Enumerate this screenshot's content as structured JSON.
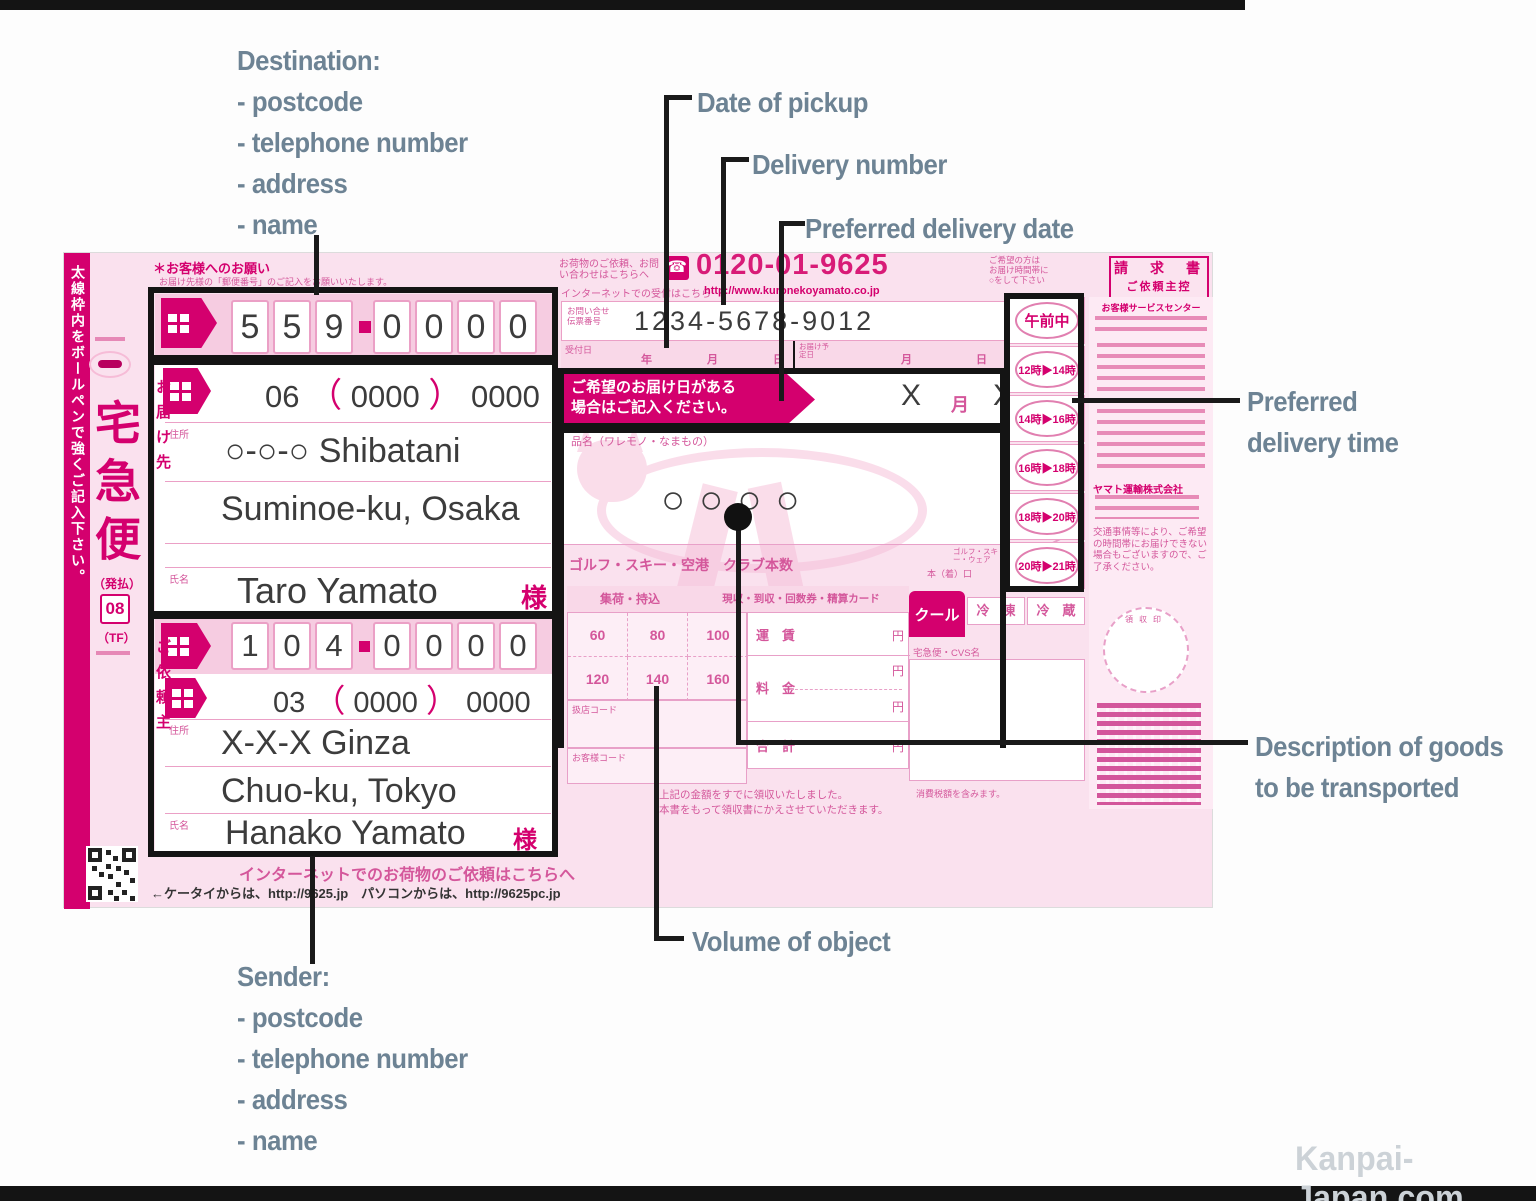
{
  "annotations": {
    "destination_title": "Destination:",
    "destination_items": [
      "- postcode",
      "- telephone number",
      "- address",
      "- name"
    ],
    "sender_title": "Sender:",
    "sender_items": [
      "- postcode",
      "- telephone number",
      "- address",
      "- name"
    ],
    "date_of_pickup": "Date of pickup",
    "delivery_number": "Delivery number",
    "preferred_delivery_date": "Preferred delivery date",
    "preferred_delivery_time_line1": "Preferred",
    "preferred_delivery_time_line2": "delivery time",
    "description_line1": "Description of goods",
    "description_line2": "to be transported",
    "volume_of_object": "Volume of object",
    "watermark": "Kanpai-Japan.com"
  },
  "form": {
    "band": "太線枠内をボールペンで強くご記入下さい。",
    "brand": {
      "service": "宅急便",
      "payment": "（発払）",
      "code": "08",
      "tf": "（TF）"
    },
    "header": {
      "note1": "＊お客様へのお願い",
      "note2": "お届け先様の「郵便番号」のご記入をお願いいたします。",
      "contact": "お荷物のご依頼、お問い合わせはこちらへ",
      "phone_icon": "☎",
      "phone": "0120-01-9625",
      "web_note": "インターネットでの受付はこちら",
      "web": "http://www.kuronekoyamato.co.jp",
      "right_note1": "ご希望の方は",
      "right_note2": "お届け時間帯に",
      "right_note3": "○をして下さい",
      "copy1": "請　求　書",
      "copy2": "ご依頼主控"
    },
    "tracking": {
      "label1": "お問い合せ",
      "label2": "伝票番号",
      "number": "1234-5678-9012"
    },
    "daterow": {
      "pickup": "受付日",
      "y": "年",
      "m": "月",
      "d": "日",
      "delivery": "お届け予定日"
    },
    "destination": {
      "vertical": "お届け先",
      "postcode": [
        "5",
        "5",
        "9",
        "0",
        "0",
        "0",
        "0"
      ],
      "tel_area": "06",
      "tel_open": "（",
      "tel_mid": "0000",
      "tel_close": "）",
      "tel_last": "0000",
      "addr_label": "住所",
      "address1": "○-○-○ Shibatani",
      "address2": "Suminoe-ku, Osaka",
      "name_label": "氏名",
      "name": "Taro Yamato",
      "sama": "様"
    },
    "sender_block": {
      "vertical": "ご依頼主",
      "postcode": [
        "1",
        "0",
        "4",
        "0",
        "0",
        "0",
        "0"
      ],
      "tel_area": "03",
      "tel_open": "（",
      "tel_mid": "0000",
      "tel_close": "）",
      "tel_last": "0000",
      "addr_label": "住所",
      "address1": "X-X-X Ginza",
      "address2": "Chuo-ku, Tokyo",
      "name_label": "氏名",
      "name": "Hanako Yamato",
      "sama": "様"
    },
    "prefdate": {
      "banner1": "ご希望のお届け日がある",
      "banner2": "場合はご記入ください。",
      "xm": "X",
      "m": "月",
      "xd": "X",
      "d": "日"
    },
    "goods": {
      "label": "品名（ワレモノ・なまもの）",
      "value": "○○○○"
    },
    "golf": {
      "label": "ゴルフ・スキー・空港　クラブ本数",
      "note1": "ゴルフ・スキー・ウェア",
      "note2": "本（着）口"
    },
    "fare": {
      "h1": "集荷・持込",
      "h2": "現収・到収・回数券・精算カード",
      "sizes": [
        "60",
        "80",
        "100",
        "120",
        "140",
        "160"
      ],
      "r1": "運　賃",
      "r2": "料　金",
      "r3": "合　計",
      "yen": "円",
      "cool": "クール",
      "frozen": "冷　凍",
      "chilled": "冷　蔵",
      "cvs": "宅急便・CVS名",
      "code1": "扱店コード",
      "code2": "お客様コード",
      "tax": "消費税額を含みます。"
    },
    "receipt1": "上記の金額をすでに領収いたしました。",
    "receipt2": "本書をもって領収書にかえさせていただきます。",
    "times": [
      "午前中",
      "12時▶14時",
      "14時▶16時",
      "16時▶18時",
      "18時▶20時",
      "20時▶21時"
    ],
    "right_col": {
      "sc": "お客様サービスセンター",
      "company": "ヤマト運輸株式会社",
      "notice": "交通事情等により、ご希望の時間帯にお届けできない場合もございますので、ご了承ください。",
      "stamp": "領収印"
    },
    "internet": {
      "line1": "インターネットでのお荷物のご依頼はこちらへ",
      "line2": "←ケータイからは、http://9625.jp　パソコンからは、http://9625pc.jp"
    }
  }
}
